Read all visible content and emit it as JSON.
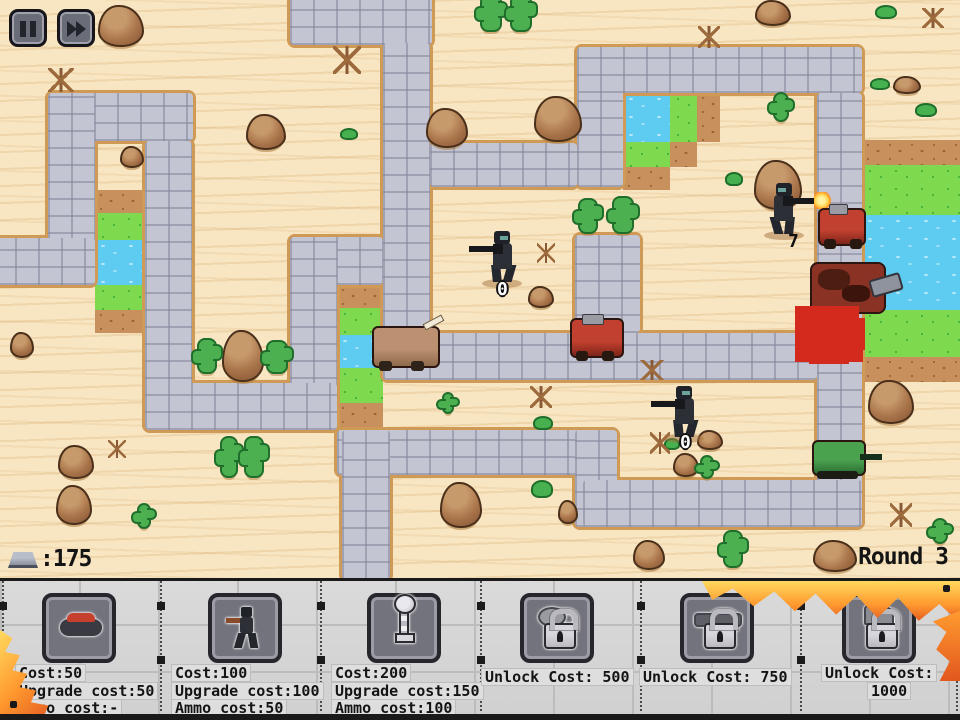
{
  "hud": {
    "money": ":175",
    "round_label": "Round 3",
    "buttons": [
      {
        "name": "pause-button",
        "icon": "pause-icon"
      },
      {
        "name": "fast-forward-button",
        "icon": "fast-forward-icon"
      }
    ],
    "money_icon": "metal-ingot-icon"
  },
  "palette": {
    "sand": "#f8e5c2",
    "path": "#c3c5d2",
    "path_border": "#cf9a55",
    "water": "#5ecbf0",
    "grass": "#7ed94e",
    "dirt": "#c8905c",
    "panel": "#d6d6d6",
    "flame": "#ff9b30"
  },
  "map": {
    "paths": [
      {
        "x": 290,
        "y": -8,
        "w": 142,
        "h": 53
      },
      {
        "x": 383,
        "y": 43,
        "w": 47,
        "h": 337
      },
      {
        "x": 430,
        "y": 143,
        "w": 147,
        "h": 44
      },
      {
        "x": 577,
        "y": 47,
        "w": 46,
        "h": 140
      },
      {
        "x": 577,
        "y": 47,
        "w": 285,
        "h": 46
      },
      {
        "x": 817,
        "y": 93,
        "w": 45,
        "h": 434
      },
      {
        "x": 383,
        "y": 333,
        "w": 434,
        "h": 47
      },
      {
        "x": 575,
        "y": 235,
        "w": 65,
        "h": 98
      },
      {
        "x": 290,
        "y": 237,
        "w": 93,
        "h": 48
      },
      {
        "x": 290,
        "y": 237,
        "w": 47,
        "h": 193
      },
      {
        "x": 145,
        "y": 383,
        "w": 192,
        "h": 47
      },
      {
        "x": 145,
        "y": 141,
        "w": 47,
        "h": 289
      },
      {
        "x": 48,
        "y": 93,
        "w": 145,
        "h": 48
      },
      {
        "x": 48,
        "y": 93,
        "w": 47,
        "h": 192
      },
      {
        "x": -8,
        "y": 238,
        "w": 103,
        "h": 47
      },
      {
        "x": 337,
        "y": 430,
        "w": 280,
        "h": 45
      },
      {
        "x": 342,
        "y": 430,
        "w": 48,
        "h": 150
      },
      {
        "x": 575,
        "y": 430,
        "w": 42,
        "h": 97
      },
      {
        "x": 583,
        "y": 480,
        "w": 279,
        "h": 47
      }
    ],
    "terrain": [
      {
        "t": "dirt",
        "x": 95,
        "y": 190,
        "w": 50,
        "h": 23
      },
      {
        "t": "grass",
        "x": 95,
        "y": 213,
        "w": 50,
        "h": 27
      },
      {
        "t": "water",
        "x": 95,
        "y": 240,
        "w": 50,
        "h": 45
      },
      {
        "t": "grass",
        "x": 95,
        "y": 285,
        "w": 50,
        "h": 25
      },
      {
        "t": "dirt",
        "x": 95,
        "y": 310,
        "w": 50,
        "h": 23
      },
      {
        "t": "dirt",
        "x": 337,
        "y": 285,
        "w": 46,
        "h": 23
      },
      {
        "t": "grass",
        "x": 337,
        "y": 308,
        "w": 46,
        "h": 27
      },
      {
        "t": "water",
        "x": 337,
        "y": 335,
        "w": 46,
        "h": 33
      },
      {
        "t": "grass",
        "x": 337,
        "y": 368,
        "w": 46,
        "h": 35
      },
      {
        "t": "dirt",
        "x": 337,
        "y": 403,
        "w": 46,
        "h": 27
      },
      {
        "t": "water",
        "x": 623,
        "y": 93,
        "w": 47,
        "h": 49
      },
      {
        "t": "grass",
        "x": 670,
        "y": 93,
        "w": 27,
        "h": 49
      },
      {
        "t": "dirt",
        "x": 697,
        "y": 93,
        "w": 23,
        "h": 49
      },
      {
        "t": "grass",
        "x": 623,
        "y": 142,
        "w": 47,
        "h": 25
      },
      {
        "t": "dirt",
        "x": 670,
        "y": 142,
        "w": 27,
        "h": 25
      },
      {
        "t": "dirt",
        "x": 623,
        "y": 167,
        "w": 47,
        "h": 23
      },
      {
        "t": "dirt",
        "x": 862,
        "y": 140,
        "w": 98,
        "h": 25
      },
      {
        "t": "grass",
        "x": 862,
        "y": 165,
        "w": 98,
        "h": 50
      },
      {
        "t": "water",
        "x": 862,
        "y": 215,
        "w": 98,
        "h": 95
      },
      {
        "t": "grass",
        "x": 862,
        "y": 310,
        "w": 98,
        "h": 47
      },
      {
        "t": "dirt",
        "x": 862,
        "y": 357,
        "w": 98,
        "h": 25
      }
    ],
    "rocks": [
      {
        "x": 98,
        "y": 5,
        "w": 46,
        "h": 42
      },
      {
        "x": 246,
        "y": 114,
        "w": 40,
        "h": 36
      },
      {
        "x": 426,
        "y": 108,
        "w": 42,
        "h": 40
      },
      {
        "x": 534,
        "y": 96,
        "w": 48,
        "h": 46
      },
      {
        "x": 754,
        "y": 160,
        "w": 48,
        "h": 50
      },
      {
        "x": 893,
        "y": 76,
        "w": 28,
        "h": 18
      },
      {
        "x": 868,
        "y": 380,
        "w": 46,
        "h": 44
      },
      {
        "x": 222,
        "y": 330,
        "w": 42,
        "h": 52
      },
      {
        "x": 528,
        "y": 286,
        "w": 26,
        "h": 22
      },
      {
        "x": 120,
        "y": 146,
        "w": 24,
        "h": 22
      },
      {
        "x": 697,
        "y": 430,
        "w": 26,
        "h": 20
      },
      {
        "x": 673,
        "y": 453,
        "w": 26,
        "h": 24
      },
      {
        "x": 440,
        "y": 482,
        "w": 42,
        "h": 46
      },
      {
        "x": 558,
        "y": 500,
        "w": 20,
        "h": 24
      },
      {
        "x": 633,
        "y": 540,
        "w": 32,
        "h": 30
      },
      {
        "x": 813,
        "y": 540,
        "w": 44,
        "h": 32
      },
      {
        "x": 58,
        "y": 445,
        "w": 36,
        "h": 34
      },
      {
        "x": 56,
        "y": 485,
        "w": 36,
        "h": 40
      },
      {
        "x": 10,
        "y": 332,
        "w": 24,
        "h": 26
      },
      {
        "x": 755,
        "y": 0,
        "w": 36,
        "h": 26
      }
    ],
    "cacti": [
      {
        "x": 480,
        "y": -6,
        "w": 22,
        "h": 38
      },
      {
        "x": 510,
        "y": -6,
        "w": 22,
        "h": 38
      },
      {
        "x": 578,
        "y": 198,
        "w": 20,
        "h": 36
      },
      {
        "x": 612,
        "y": 196,
        "w": 22,
        "h": 38
      },
      {
        "x": 197,
        "y": 338,
        "w": 20,
        "h": 36
      },
      {
        "x": 266,
        "y": 340,
        "w": 22,
        "h": 34
      },
      {
        "x": 220,
        "y": 436,
        "w": 18,
        "h": 42
      },
      {
        "x": 244,
        "y": 436,
        "w": 20,
        "h": 42
      },
      {
        "x": 137,
        "y": 503,
        "w": 14,
        "h": 26
      },
      {
        "x": 773,
        "y": 92,
        "w": 16,
        "h": 30
      },
      {
        "x": 700,
        "y": 455,
        "w": 14,
        "h": 24
      },
      {
        "x": 723,
        "y": 530,
        "w": 20,
        "h": 38
      },
      {
        "x": 932,
        "y": 518,
        "w": 16,
        "h": 26
      },
      {
        "x": 442,
        "y": 392,
        "w": 12,
        "h": 22
      }
    ],
    "bushes": [
      {
        "x": 340,
        "y": 128,
        "w": 18,
        "h": 12
      },
      {
        "x": 870,
        "y": 78,
        "w": 20,
        "h": 12
      },
      {
        "x": 915,
        "y": 103,
        "w": 22,
        "h": 14
      },
      {
        "x": 725,
        "y": 172,
        "w": 18,
        "h": 14
      },
      {
        "x": 664,
        "y": 438,
        "w": 16,
        "h": 12
      },
      {
        "x": 531,
        "y": 480,
        "w": 22,
        "h": 18
      },
      {
        "x": 533,
        "y": 416,
        "w": 20,
        "h": 14
      },
      {
        "x": 875,
        "y": 5,
        "w": 22,
        "h": 14
      }
    ],
    "deadbushes": [
      {
        "x": 48,
        "y": 68,
        "w": 26,
        "h": 24
      },
      {
        "x": 333,
        "y": 46,
        "w": 28,
        "h": 28
      },
      {
        "x": 537,
        "y": 243,
        "w": 18,
        "h": 20
      },
      {
        "x": 640,
        "y": 360,
        "w": 24,
        "h": 20
      },
      {
        "x": 650,
        "y": 432,
        "w": 20,
        "h": 22
      },
      {
        "x": 530,
        "y": 386,
        "w": 22,
        "h": 22
      },
      {
        "x": 922,
        "y": 8,
        "w": 22,
        "h": 20
      },
      {
        "x": 890,
        "y": 503,
        "w": 22,
        "h": 24
      },
      {
        "x": 698,
        "y": 26,
        "w": 22,
        "h": 22
      },
      {
        "x": 108,
        "y": 440,
        "w": 18,
        "h": 18
      }
    ],
    "units": [
      {
        "type": "soldier",
        "x": 478,
        "y": 228,
        "w": 48,
        "h": 58,
        "dir": "left",
        "firing": false,
        "ammo": "0",
        "ammo_style": "light",
        "ammo_x": 497,
        "ammo_y": 281
      },
      {
        "type": "soldier",
        "x": 760,
        "y": 180,
        "w": 48,
        "h": 58,
        "dir": "right",
        "firing": true,
        "ammo": "7",
        "ammo_style": "dark",
        "ammo_x": 788,
        "ammo_y": 233
      },
      {
        "type": "soldier",
        "x": 660,
        "y": 383,
        "w": 48,
        "h": 58,
        "dir": "left",
        "firing": false,
        "ammo": "0",
        "ammo_style": "light",
        "ammo_x": 680,
        "ammo_y": 434
      },
      {
        "type": "enemy-tan",
        "x": 372,
        "y": 326,
        "w": 68,
        "h": 42
      },
      {
        "type": "enemy-red",
        "x": 570,
        "y": 318,
        "w": 54,
        "h": 40
      },
      {
        "type": "enemy-red",
        "x": 818,
        "y": 208,
        "w": 48,
        "h": 38
      },
      {
        "type": "enemy-cluster",
        "x": 810,
        "y": 262,
        "w": 76,
        "h": 52
      },
      {
        "type": "enemy-green",
        "x": 812,
        "y": 440,
        "w": 54,
        "h": 36
      },
      {
        "type": "damage",
        "x": 795,
        "y": 306,
        "w": 40,
        "h": 32
      }
    ]
  },
  "panel": {
    "separators_x": [
      2,
      160,
      320,
      480,
      640,
      800,
      956
    ],
    "slots": [
      {
        "name": "landmine",
        "icon": "mine",
        "locked": false,
        "button_x": 42,
        "lines": [
          {
            "t": "Cost:50",
            "x": 16,
            "y": 84
          },
          {
            "t": "Upgrade cost:50",
            "x": 16,
            "y": 102
          },
          {
            "t": "Ammo cost:-",
            "x": 16,
            "y": 119
          }
        ]
      },
      {
        "name": "rifleman",
        "icon": "soldier",
        "locked": false,
        "button_x": 208,
        "lines": [
          {
            "t": "Cost:100",
            "x": 172,
            "y": 84
          },
          {
            "t": "Upgrade cost:100",
            "x": 172,
            "y": 102
          },
          {
            "t": "Ammo cost:50",
            "x": 172,
            "y": 119
          }
        ]
      },
      {
        "name": "periscope",
        "icon": "scope",
        "locked": false,
        "button_x": 367,
        "lines": [
          {
            "t": "Cost:200",
            "x": 332,
            "y": 84
          },
          {
            "t": "Upgrade cost:150",
            "x": 332,
            "y": 102
          },
          {
            "t": "Ammo cost:100",
            "x": 332,
            "y": 119
          }
        ]
      },
      {
        "name": "locked-1",
        "icon": "lock-blob",
        "locked": true,
        "button_x": 520,
        "lines": [
          {
            "t": "Unlock Cost: 500",
            "x": 482,
            "y": 88
          }
        ]
      },
      {
        "name": "locked-2",
        "icon": "lock-cannon",
        "locked": true,
        "button_x": 680,
        "lines": [
          {
            "t": "Unlock Cost: 750",
            "x": 640,
            "y": 88
          }
        ]
      },
      {
        "name": "locked-3",
        "icon": "lock-turret",
        "locked": true,
        "button_x": 842,
        "lines": [
          {
            "t": "Unlock Cost:",
            "x": 822,
            "y": 84
          },
          {
            "t": "1000",
            "x": 868,
            "y": 102
          }
        ]
      }
    ]
  }
}
